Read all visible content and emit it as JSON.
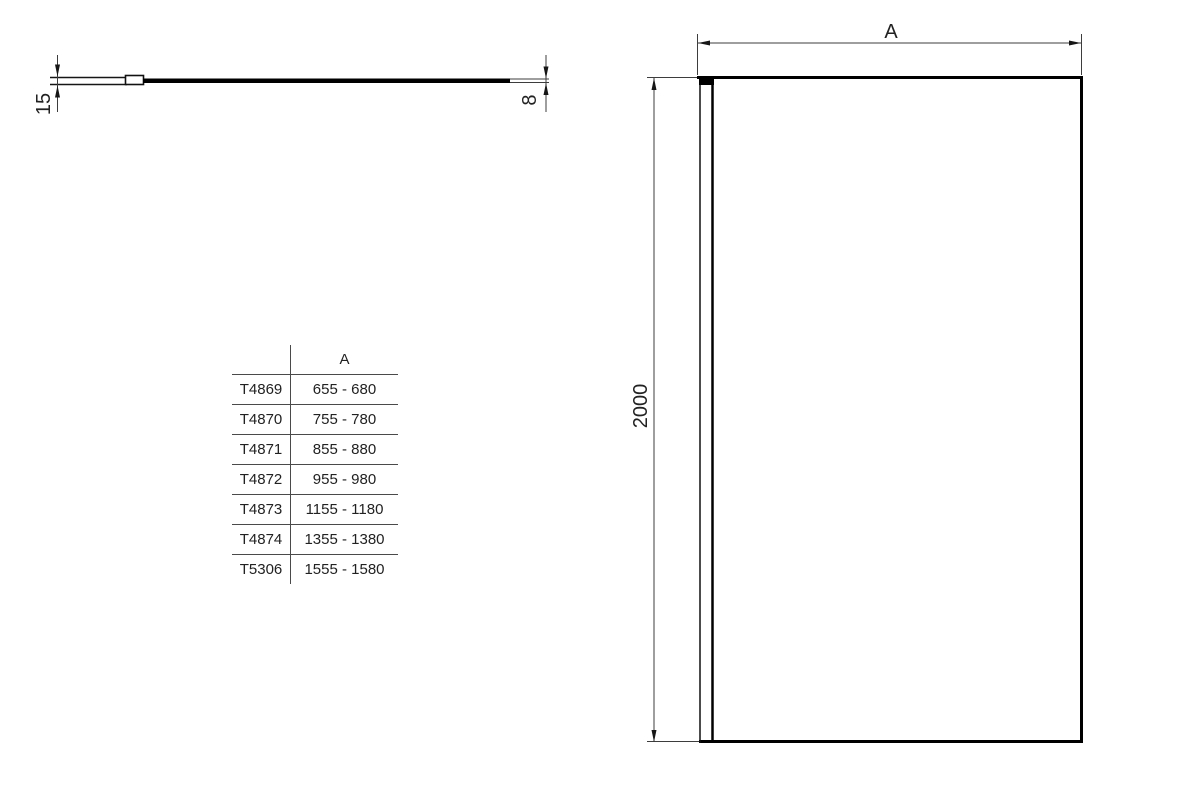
{
  "top_view": {
    "profile_depth_dim": "15",
    "glass_thickness_dim": "8"
  },
  "front_view": {
    "width_dim_label": "A",
    "height_dim": "2000"
  },
  "size_table": {
    "code_header": "",
    "width_header": "A",
    "rows": [
      {
        "code": "T4869",
        "width_range": "655 - 680"
      },
      {
        "code": "T4870",
        "width_range": "755 - 780"
      },
      {
        "code": "T4871",
        "width_range": "855 - 880"
      },
      {
        "code": "T4872",
        "width_range": "955 - 980"
      },
      {
        "code": "T4873",
        "width_range": "1155 - 1180"
      },
      {
        "code": "T4874",
        "width_range": "1355 - 1380"
      },
      {
        "code": "T5306",
        "width_range": "1555 - 1580"
      }
    ]
  },
  "colors": {
    "background": "#ffffff",
    "thick_line": "#000000",
    "thin_line": "#3d3d3d",
    "text": "#222222"
  }
}
